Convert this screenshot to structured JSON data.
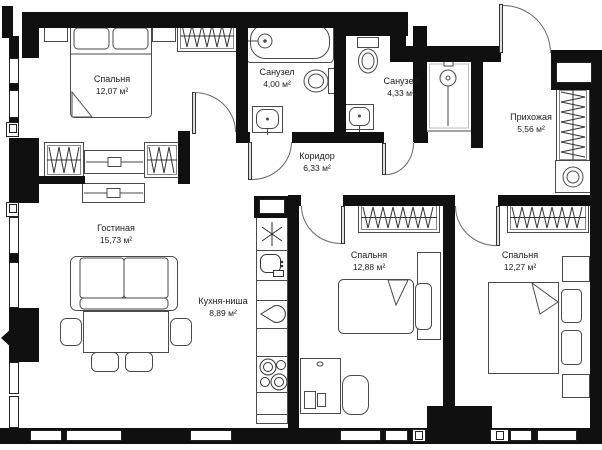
{
  "labels": [
    {
      "id": "bedroom-1",
      "name": "Спальня",
      "area": "12,07 м²"
    },
    {
      "id": "bath-1",
      "name": "Санузел",
      "area": "4,00 м²"
    },
    {
      "id": "bath-2",
      "name": "Санузел",
      "area": "4,33 м²"
    },
    {
      "id": "hallway",
      "name": "Прихожая",
      "area": "5,56 м²"
    },
    {
      "id": "corridor",
      "name": "Коридор",
      "area": "6,33 м²"
    },
    {
      "id": "living",
      "name": "Гостиная",
      "area": "15,73 м²"
    },
    {
      "id": "kitchen",
      "name": "Кухня-ниша",
      "area": "8,89 м²"
    },
    {
      "id": "bedroom-2",
      "name": "Спальня",
      "area": "12,88 м²"
    },
    {
      "id": "bedroom-3",
      "name": "Спальня",
      "area": "12,27 м²"
    }
  ],
  "icons": {
    "fridge": "snowflake",
    "hob": "four-burners",
    "kitchen_sink": "basin",
    "water": "drop",
    "wardrobe": "hanger-zigzag"
  },
  "colors": {
    "wall": "#101010",
    "furniture_line": "#4a4a4a",
    "background": "#ffffff"
  }
}
